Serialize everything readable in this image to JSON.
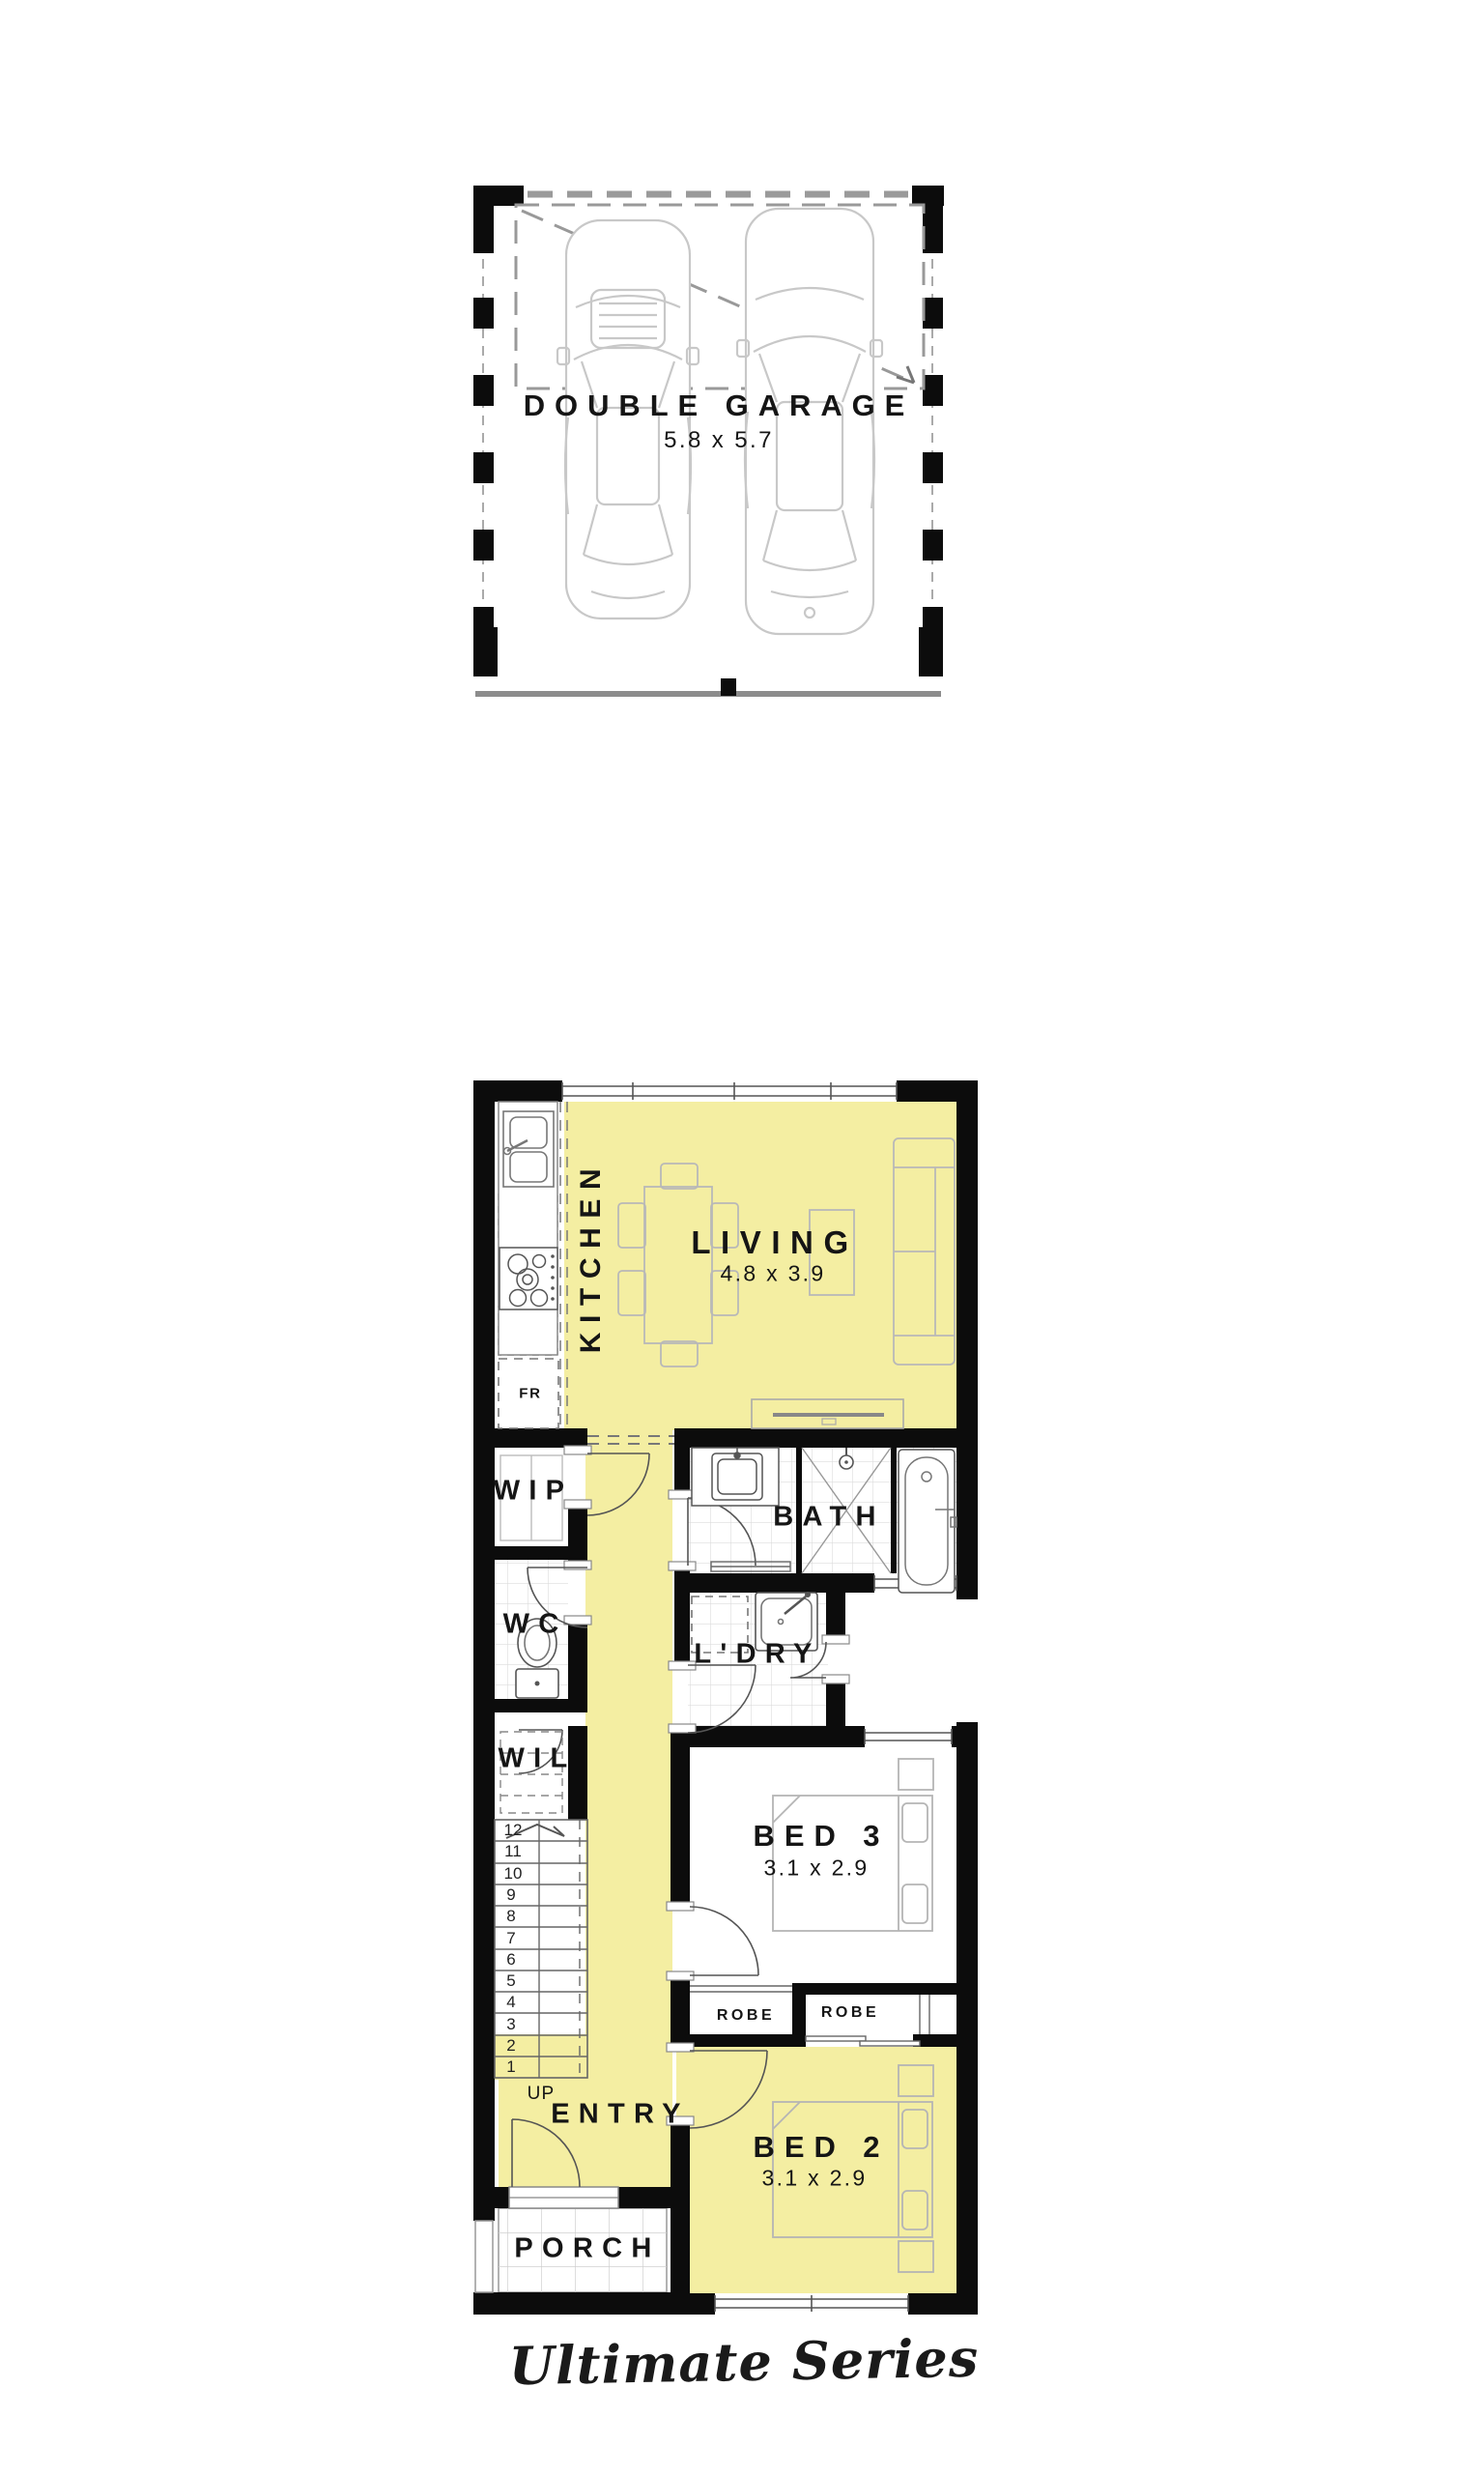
{
  "garage": {
    "title": "DOUBLE GARAGE",
    "dims": "5.8 x 5.7"
  },
  "rooms": {
    "kitchen": {
      "label": "KITCHEN"
    },
    "living": {
      "label": "LIVING",
      "dims": "4.8 x 3.9"
    },
    "wip": {
      "label": "WIP"
    },
    "wc": {
      "label": "WC"
    },
    "wil": {
      "label": "WIL"
    },
    "bath": {
      "label": "BATH"
    },
    "ldry": {
      "label": "L'DRY"
    },
    "bed3": {
      "label": "BED 3",
      "dims": "3.1 x 2.9"
    },
    "robe_left": {
      "label": "ROBE"
    },
    "robe_right": {
      "label": "ROBE"
    },
    "entry": {
      "label": "ENTRY"
    },
    "bed2": {
      "label": "BED 2",
      "dims": "3.1 x 2.9"
    },
    "porch": {
      "label": "PORCH"
    }
  },
  "kitchen_fixtures": {
    "fridge_label": "FR"
  },
  "stairs": {
    "up_label": "UP",
    "numbers": [
      "1",
      "2",
      "3",
      "4",
      "5",
      "6",
      "7",
      "8",
      "9",
      "10",
      "11",
      "12"
    ]
  },
  "series": {
    "label": "Ultimate Series"
  },
  "colors": {
    "highlight": "#F4EEA2",
    "wall": "#0C0C0C",
    "line_gray": "#9A9A9A",
    "furniture_gray": "#B8B8B8",
    "tile_gray": "#DCDCDC",
    "text": "#151515"
  }
}
